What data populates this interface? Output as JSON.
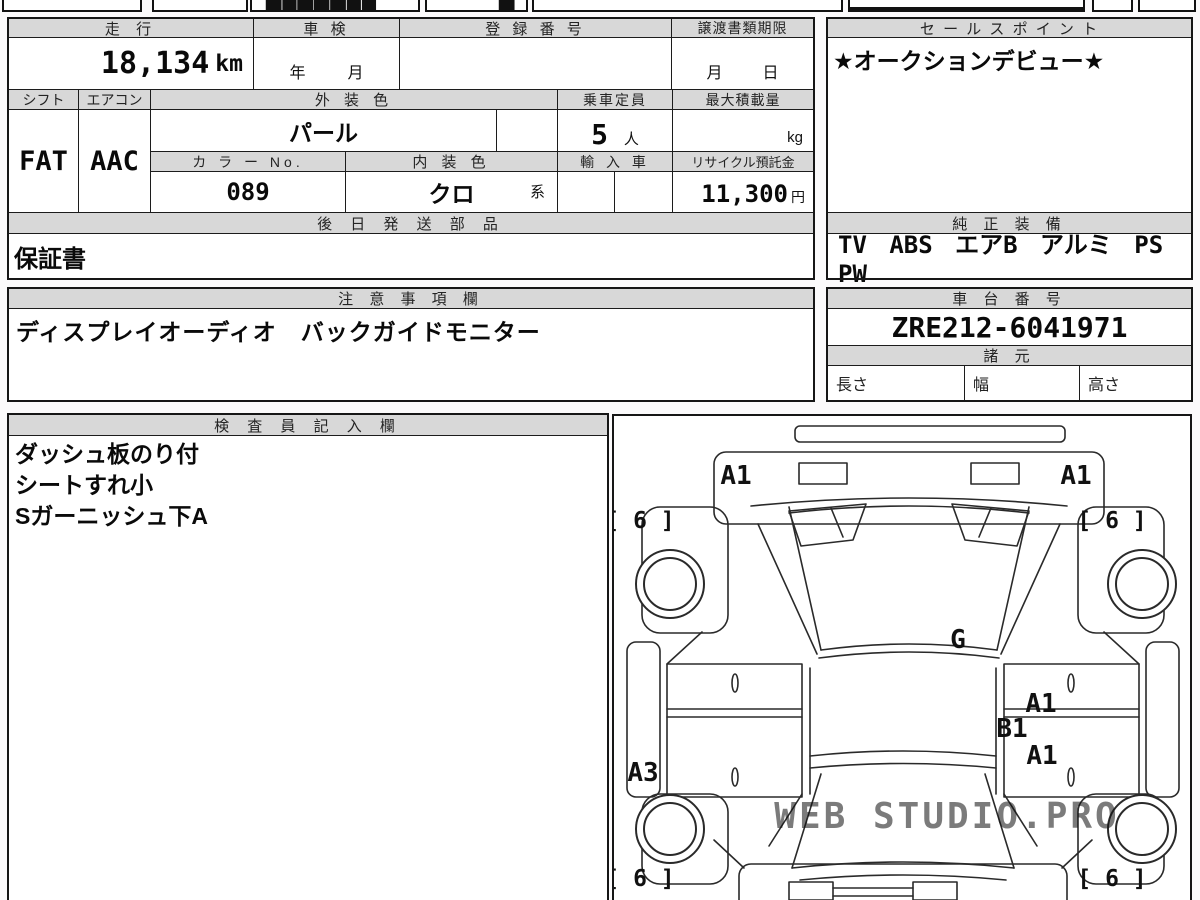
{
  "page": {
    "bg": "#f2f1f2",
    "sheet_bg": "#fbfafb",
    "header_bg": "#d8d8d8",
    "border": "#1c1c1c",
    "text": "#111111",
    "watermark_color": "#d6d6d6"
  },
  "top_row": {
    "fragments": [
      "▆█▇▅▇██",
      "▆"
    ]
  },
  "basic": {
    "headers": {
      "mileage": "走 行",
      "inspection": "車 検",
      "registration_no": "登 録 番 号",
      "transfer_deadline": "譲渡書類期限"
    },
    "mileage_value": "18,134",
    "mileage_unit": "km",
    "inspection_year_label": "年",
    "inspection_month_label": "月",
    "transfer_month_label": "月",
    "transfer_day_label": "日"
  },
  "row2": {
    "headers": {
      "shift": "シフト",
      "aircon": "エアコン",
      "exterior_color": "外 装 色",
      "capacity": "乗車定員",
      "max_load": "最大積載量",
      "color_no": "カ ラ ー No.",
      "interior_color": "内 装 色",
      "import_car": "輸 入 車",
      "recycle_deposit": "リサイクル預託金"
    },
    "shift": "FAT",
    "aircon": "AAC",
    "exterior_color": "パール",
    "color_no": "089",
    "interior_color": "クロ",
    "interior_suffix": "系",
    "capacity": "5",
    "capacity_unit": "人",
    "max_load_unit": "kg",
    "recycle_fee": "11,300",
    "recycle_unit": "円"
  },
  "later_parts": {
    "header": "後 日 発 送 部 品",
    "value": "保証書"
  },
  "sales": {
    "header": "セ ー ル ス ポ イ ン ト",
    "value": "★オークションデビュー★"
  },
  "equipment": {
    "header": "純 正 装 備",
    "value": "TV ABS エアB アルミ PS PW"
  },
  "notes": {
    "header": "注 意 事 項 欄",
    "value": "ディスプレイオーディオ　バックガイドモニター"
  },
  "chassis": {
    "header": "車 台 番 号",
    "value": "ZRE212-6041971"
  },
  "specs": {
    "header": "諸 元",
    "length_label": "長さ",
    "width_label": "幅",
    "height_label": "高さ"
  },
  "inspector": {
    "header": "検 査 員 記 入 欄",
    "lines": [
      "ダッシュ板のり付",
      "シートすれ小",
      "Sガーニッシュ下A"
    ]
  },
  "diagram": {
    "labels": [
      {
        "text": "A1"
      },
      {
        "text": "A1"
      },
      {
        "text": "[ 6 ]"
      },
      {
        "text": "[ 6 ]"
      },
      {
        "text": "G"
      },
      {
        "text": "A1"
      },
      {
        "text": "B1"
      },
      {
        "text": "A1"
      },
      {
        "text": "A3"
      },
      {
        "text": "[ 6 ]"
      },
      {
        "text": "[ 6 ]"
      }
    ],
    "watermark": "WEB STUDIO.PRO"
  }
}
